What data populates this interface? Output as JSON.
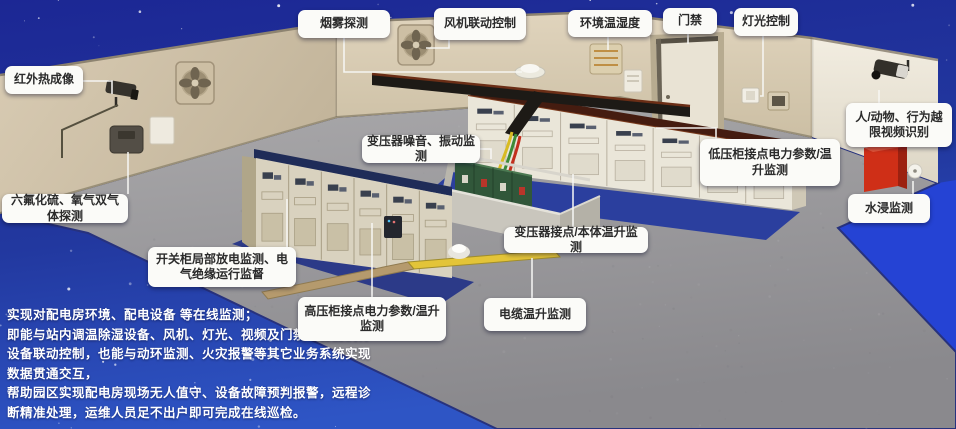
{
  "callouts": {
    "smoke_detection": {
      "label": "烟雾探测"
    },
    "fan_linkage": {
      "label": "风机联动控制"
    },
    "env_temp_humidity": {
      "label": "环境温湿度"
    },
    "door_access": {
      "label": "门禁"
    },
    "light_control": {
      "label": "灯光控制"
    },
    "infrared_thermal": {
      "label": "红外热成像"
    },
    "video_recognition": {
      "label": "人/动物、行为越限视频识别"
    },
    "gas_detection": {
      "label": "六氟化硫、氧气双气体探测"
    },
    "water_immersion": {
      "label": "水浸监测"
    },
    "transformer_noise": {
      "label": "变压器噪音、振动监测"
    },
    "lv_cabinet": {
      "label": "低压柜接点电力参数/温升监测"
    },
    "transformer_temp": {
      "label": "变压器接点/本体温升监测"
    },
    "switchgear_pd": {
      "label": "开关柜局部放电监测、电气绝缘运行监督"
    },
    "hv_cabinet": {
      "label": "高压柜接点电力参数/温升监测"
    },
    "cable_temp": {
      "label": "电缆温升监测"
    }
  },
  "description": {
    "lines": [
      "实现对配电房环境、配电设备 等在线监测；",
      "即能与站内调温除湿设备、风机、灯光、视频及门禁等智能执行",
      "设备联动控制，也能与动环监测、火灾报警等其它业务系统实现",
      "数据贯通交互，",
      "帮助园区实现配电房现场无人值守、设备故障预判报警，远程诊",
      "断精准处理，运维人员足不出户即可完成在线巡检。"
    ]
  },
  "equipment_icons": [
    "wall-fan-icon",
    "cctv-camera-icon",
    "smoke-detector-dome-icon",
    "env-sensor-icon",
    "door-icon",
    "light-switch-icon",
    "gas-detector-icon",
    "transformer-icon",
    "hv-cabinet-row-icon",
    "lv-cabinet-row-icon",
    "fire-cabinet-icon",
    "water-sensor-icon",
    "cable-trench-icon",
    "busway-icon"
  ],
  "colors": {
    "sky": "#1c2794",
    "bottom_blue": "#2e55c5",
    "floor_edge_blue": "#2543d4",
    "floor": "#9a999d",
    "wall_beige": "#d4c7ae",
    "callout_bg": "#fbfbf8",
    "callout_text": "#2b2b2b",
    "description_text": "#ffffff",
    "mat_blue": "#2b3f9e",
    "trench_yellow": "#e3c438",
    "fire_cabinet_red": "#cf2f17",
    "transformer_green": "#31573a"
  }
}
